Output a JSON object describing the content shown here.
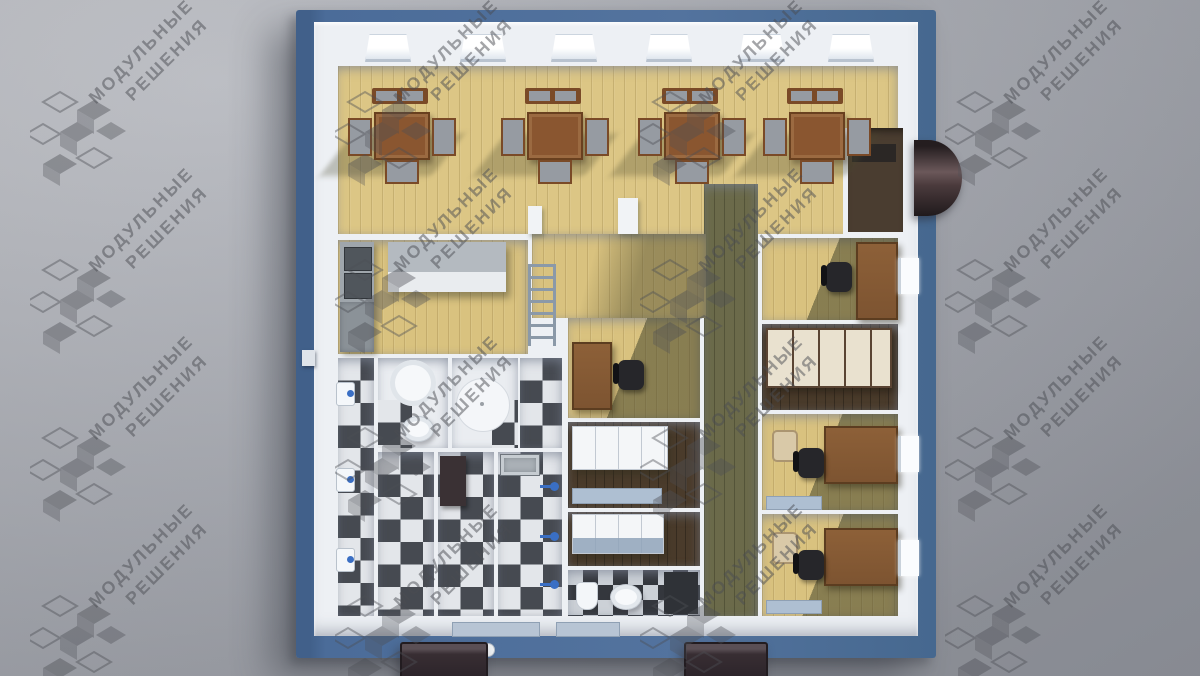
{
  "title": "Modular building interior floor plan - 3D top view render",
  "watermark": {
    "line1": "МОДУЛЬНЫЕ",
    "line2": "РЕШЕНИЯ"
  },
  "palette": {
    "background": "#a9acb4",
    "exterior_blue": "#4b6c99",
    "wall_white": "#edf0f4",
    "wood": "#d9c27f",
    "olive": "#6b6a4a",
    "checker_dark": "#464a51",
    "checker_light": "#e3e6ea",
    "accent_blue": "#3a6fc4",
    "desk_brown": "#7d5431",
    "watermark_gray": "#4d4f55"
  },
  "building": {
    "top_windows": 6,
    "dining_sets": 4,
    "wash_basins": 3,
    "shower_heads": 3,
    "east_windows": 3,
    "awnings": 2,
    "offices": 4,
    "locker_rooms": 2,
    "sanitary_rooms": 6
  }
}
